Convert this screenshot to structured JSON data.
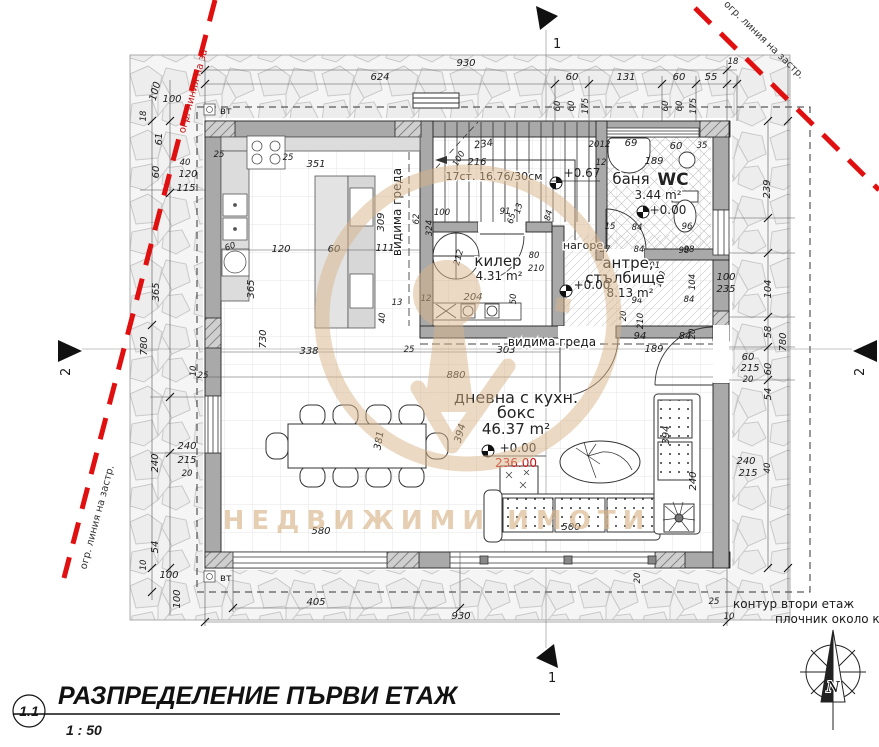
{
  "title_block": {
    "number": "1.1",
    "title": "РАЗПРЕДЕЛЕНИЕ ПЪРВИ ЕТАЖ",
    "scale": "1 : 50"
  },
  "rooms": {
    "living": {
      "name1": "дневна с кухн.",
      "name2": "бокс",
      "area": "46.37 m²",
      "level": "+0.00",
      "altitude": "236.00"
    },
    "pantry": {
      "name": "килер",
      "area": "4.31 m²"
    },
    "hall": {
      "name1": "антре,",
      "name2": "стълбище",
      "area": "8.13 m²",
      "level": "+0.00"
    },
    "bath": {
      "name": "баня",
      "wc": "WC",
      "area": "3.44 m²",
      "level": "+0.00"
    }
  },
  "stairs": {
    "label": "17ст. 16.76/30см",
    "level": "+0.67",
    "direction": "нагоре"
  },
  "notes": {
    "beam_vertical": "видима греда",
    "beam_horizontal": "видима греда",
    "vt_top": "вт",
    "vt_bottom": "вт",
    "second_floor_contour": "контур втори етаж",
    "paving_note": "плочник около къща",
    "regulation_top_left": "огр. линия на за",
    "regulation_bottom_left": "огр. линия на застр.",
    "regulation_top_right": "огр. линия на застр."
  },
  "watermark": {
    "text": "НЕДВИЖИМИ ИМОТИ"
  },
  "compass": {
    "north": "N"
  },
  "sections": {
    "s1": "1",
    "s2": "2"
  },
  "colors": {
    "regulation_line": "#e01010",
    "altitude_red": "#c81414",
    "wall_fill": "#a9a9a9",
    "watermark_tan": "#d8b488"
  },
  "dims": {
    "top": [
      "930",
      "624",
      "60",
      "131",
      "60",
      "55",
      "18"
    ],
    "win": [
      "60",
      "60",
      "175"
    ],
    "left": [
      "100",
      "100",
      "18",
      "61",
      "60",
      "40",
      "120",
      "115",
      "365",
      "780",
      "10",
      "25",
      "240",
      "215",
      "20",
      "240",
      "54",
      "10",
      "100",
      "100"
    ],
    "right": [
      "239",
      "104",
      "58",
      "780",
      "100",
      "235",
      "60",
      "215",
      "20",
      "60",
      "54",
      "240",
      "215",
      "40"
    ],
    "bottom": [
      "405",
      "930",
      "580",
      "25",
      "10",
      "20"
    ],
    "kitchen": [
      "351",
      "25",
      "25",
      "120",
      "60",
      "111",
      "309",
      "365",
      "730",
      "338",
      "13",
      "40",
      "60",
      "12",
      "204",
      "50",
      "303",
      "25",
      "880",
      "394",
      "381",
      "394"
    ],
    "stairs": [
      "234",
      "216",
      "100",
      "91",
      "62",
      "65",
      "13",
      "84",
      "80",
      "210",
      "100",
      "324",
      "212"
    ],
    "hall": [
      "201",
      "130",
      "104",
      "84",
      "94",
      "94",
      "84",
      "20",
      "189",
      "210",
      "20",
      "98"
    ],
    "bath": [
      "20",
      "12",
      "69",
      "60",
      "35",
      "189",
      "12",
      "15",
      "84",
      "96",
      "27",
      "84",
      "98"
    ],
    "livingf": [
      "500",
      "240"
    ]
  }
}
